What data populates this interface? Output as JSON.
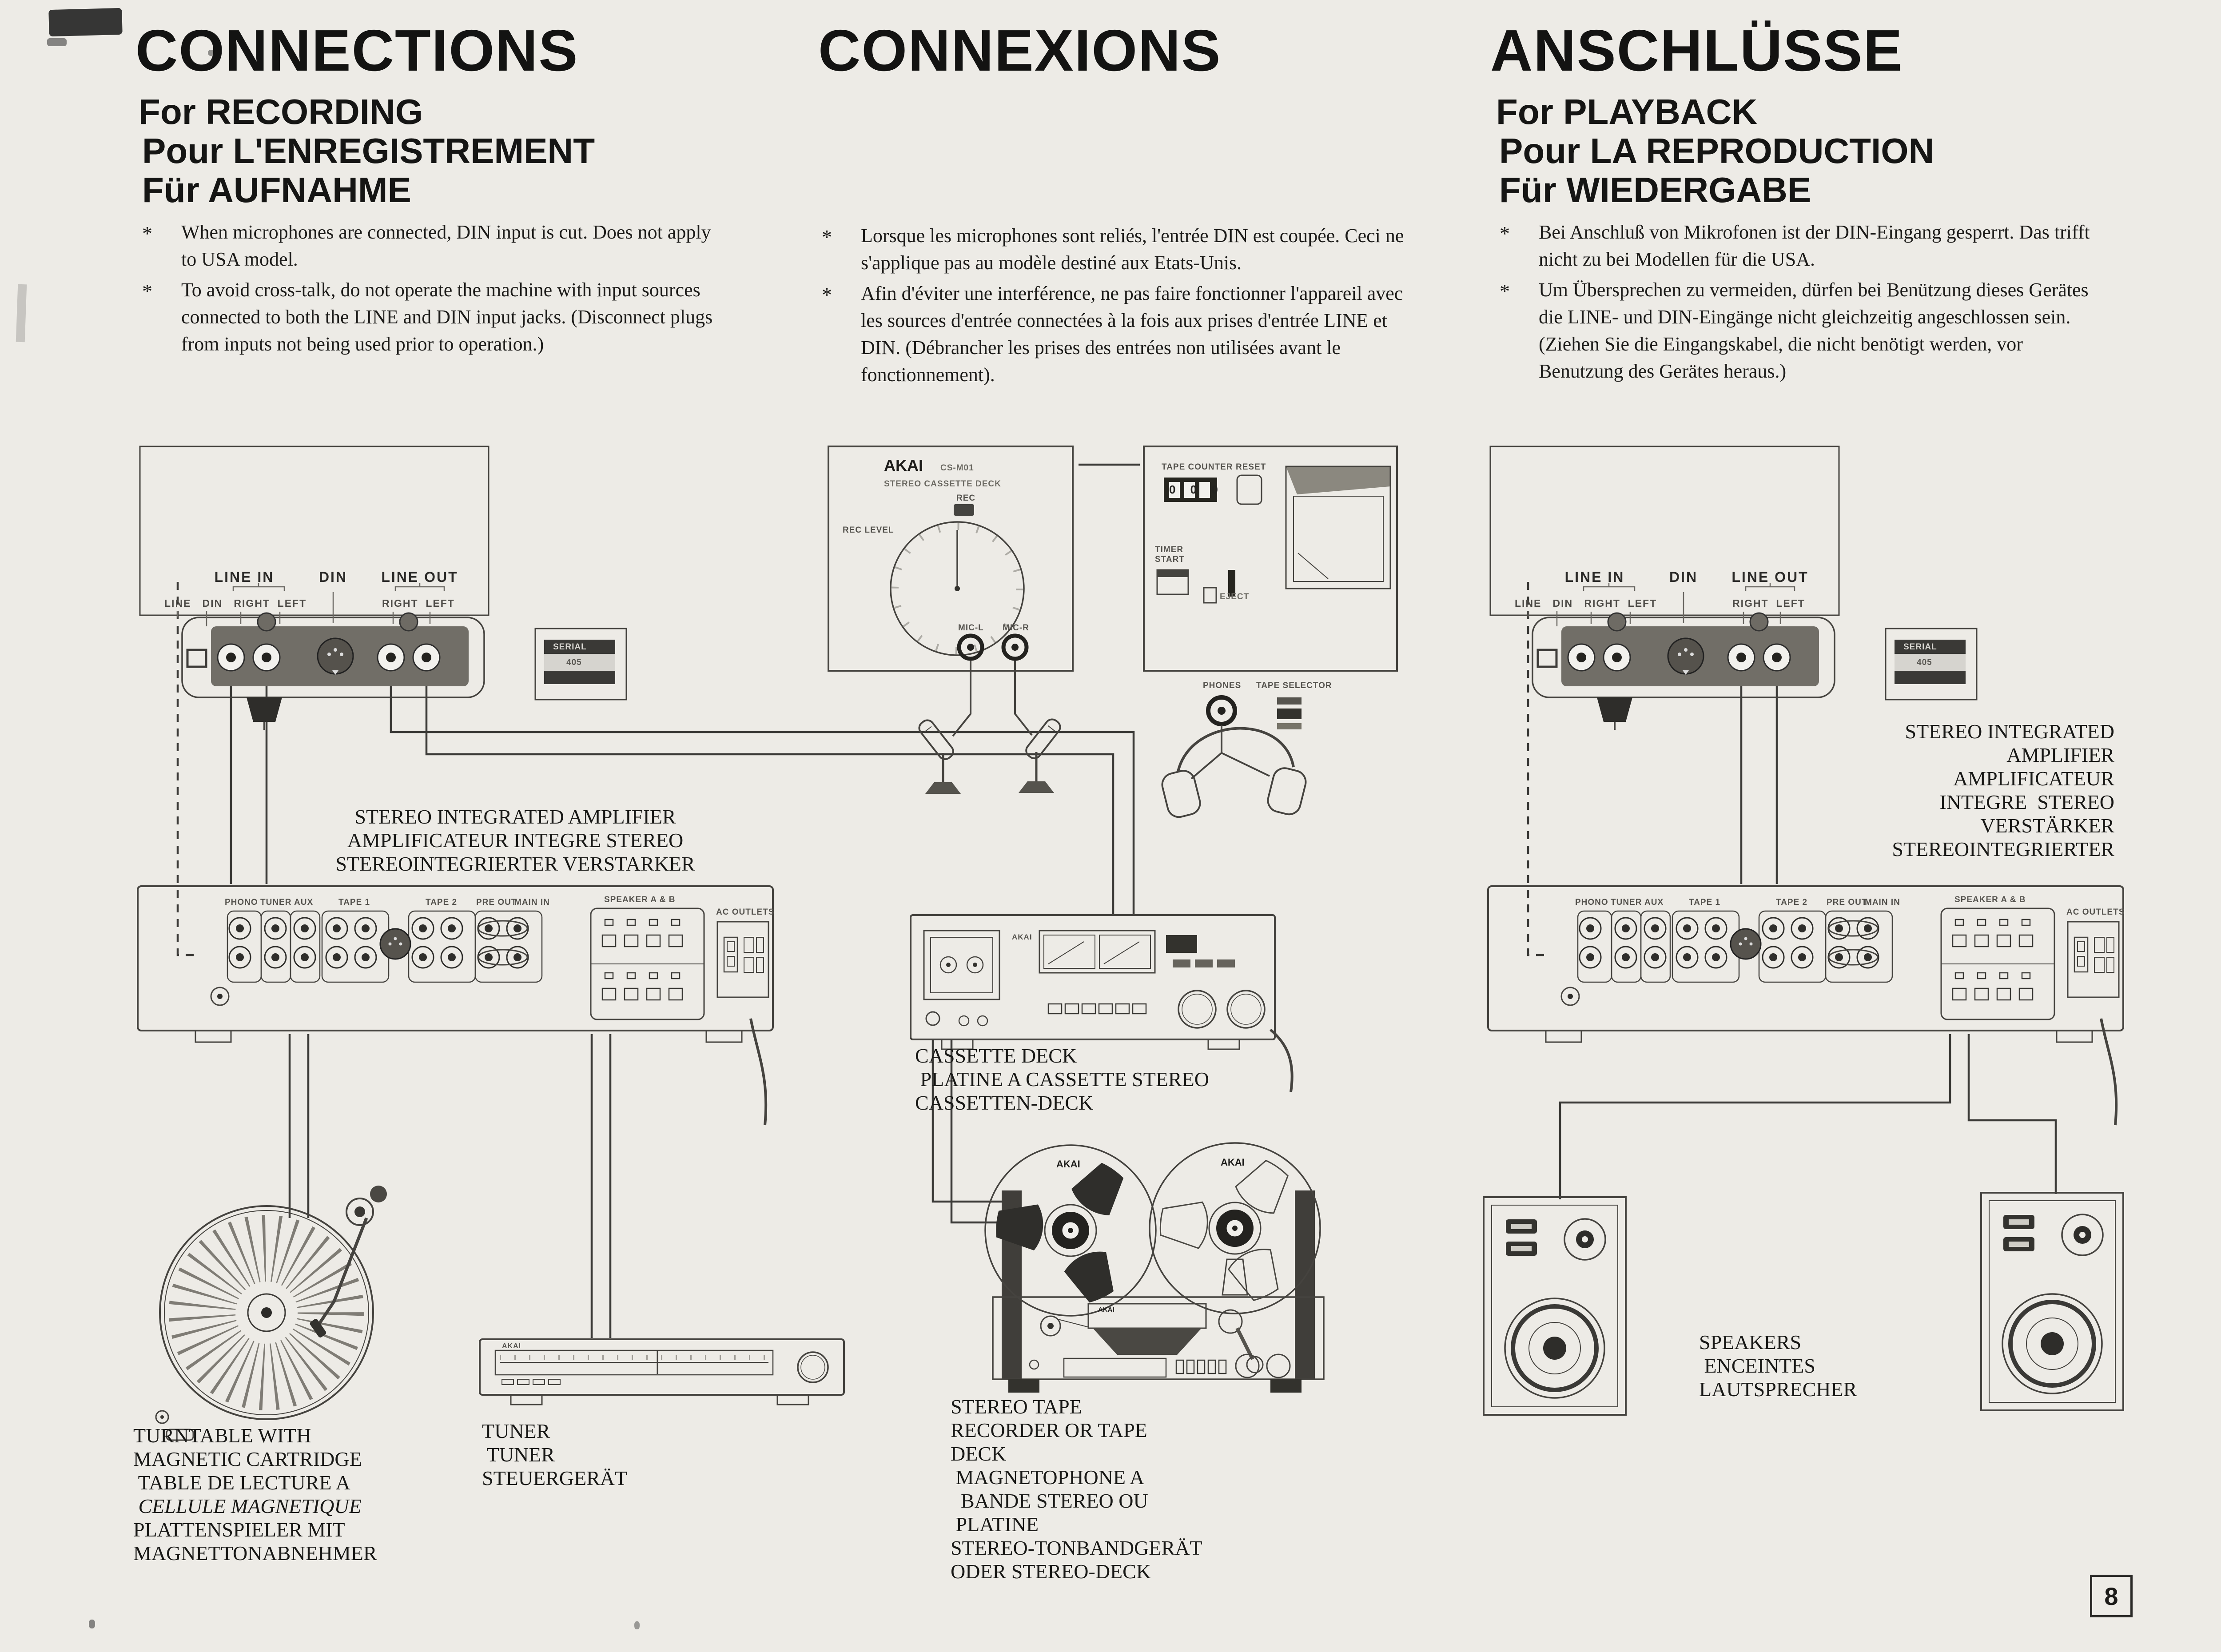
{
  "misc": {
    "bullet": "*",
    "page_number": "8"
  },
  "sections": {
    "recording": {
      "title": "CONNECTIONS",
      "sub1": "For RECORDING",
      "sub2": "Pour L'ENREGISTREMENT",
      "sub3": "Für AUFNAHME",
      "note1": "When microphones are connected, DIN input is cut. Does not apply to USA model.",
      "note2": "To avoid cross-talk, do not operate the machine with input sources connected to both the LINE and DIN input jacks. (Disconnect plugs from inputs not being used prior to operation.)"
    },
    "connexions": {
      "title": "CONNEXIONS",
      "note1": "Lorsque les microphones sont reliés, l'entrée DIN est coupée. Ceci ne s'applique pas au modèle destiné aux Etats-Unis.",
      "note2": "Afin d'éviter une interférence, ne pas faire fonctionner l'appareil avec les sources d'entrée connectées à la fois aux prises d'entrée LINE et DIN. (Débrancher les prises des entrées non utilisées avant le fonctionnement)."
    },
    "playback": {
      "title": "ANSCHLÜSSE",
      "sub1": "For PLAYBACK",
      "sub2": "Pour LA REPRODUCTION",
      "sub3": "Für WIEDERGABE",
      "note1": "Bei Anschluß von Mikrofonen ist der DIN-Eingang gesperrt.  Das trifft nicht zu bei Modellen für die USA.",
      "note2": "Um Übersprechen zu vermeiden, dürfen bei Benützung dieses Gerätes die LINE- und DIN-Eingänge nicht gleichzeitig angeschlossen sein. (Ziehen Sie die Eingangskabel, die nicht benötigt werden, vor Benutzung des Gerätes heraus.)"
    }
  },
  "deck_rear": {
    "line_in": "LINE IN",
    "din": "DIN",
    "line_out": "LINE OUT",
    "small_left": "LINE   DIN   RIGHT  LEFT",
    "small_right": "RIGHT  LEFT",
    "serial": "SERIAL",
    "serial_no": "405"
  },
  "amp_panel": {
    "phono": "PHONO",
    "tuner": "TUNER",
    "aux": "AUX",
    "tape1": "TAPE 1",
    "tape2": "TAPE 2",
    "pre_out": "PRE OUT",
    "main_in": "MAIN IN",
    "rec": "REC",
    "play": "PLAY",
    "speakers": "SPEAKER A & B",
    "ac": "AC OUTLETS"
  },
  "captions": {
    "amp_left": {
      "l1": "STEREO INTEGRATED AMPLIFIER",
      "l2": "AMPLIFICATEUR INTEGRE STEREO",
      "l3": "STEREOINTEGRIERTER VERSTARKER"
    },
    "amp_right": {
      "l1": "STEREO INTEGRATED",
      "l2": "AMPLIFIER",
      "l3": "AMPLIFICATEUR",
      "l4": "INTEGRE  STEREO",
      "l5": "VERSTÄRKER",
      "l6": "STEREOINTEGRIERTER"
    },
    "cassette_deck": {
      "l1": "CASSETTE DECK",
      "l2": " PLATINE A CASSETTE STEREO",
      "l3": "CASSETTEN-DECK"
    },
    "turntable": {
      "l1": "TURNTABLE WITH",
      "l2": "MAGNETIC CARTRIDGE",
      "l3": " TABLE DE LECTURE A",
      "l4": " CELLULE MAGNETIQUE",
      "l5": "PLATTENSPIELER MIT",
      "l6": "MAGNETTONABNEHMER"
    },
    "tuner": {
      "l1": "TUNER",
      "l2": " TUNER",
      "l3": "STEUERGERÄT"
    },
    "tape_recorder": {
      "l1": "STEREO TAPE",
      "l2": "RECORDER OR TAPE",
      "l3": "DECK",
      "l4": " MAGNETOPHONE A",
      "l5": "  BANDE STEREO OU",
      "l6": " PLATINE",
      "l7": "STEREO-TONBANDGERÄT",
      "l8": "ODER STEREO-DECK"
    },
    "speakers": {
      "l1": "SPEAKERS",
      "l2": " ENCEINTES",
      "l3": "LAUTSPRECHER"
    }
  },
  "middeck": {
    "brand": "AKAI",
    "model": "CS-M01",
    "type": "STEREO CASSETTE DECK",
    "rec": "REC",
    "rec_level": "REC LEVEL",
    "mic_l": "MIC-L",
    "mic_r": "MIC-R",
    "tape_counter": "TAPE COUNTER",
    "reset": "RESET",
    "timer_start": "TIMER START",
    "eject": "EJECT",
    "phones": "PHONES",
    "tape_selector": "TAPE SELECTOR",
    "digits": "0 0 0"
  },
  "reel": {
    "brand": "AKAI"
  }
}
